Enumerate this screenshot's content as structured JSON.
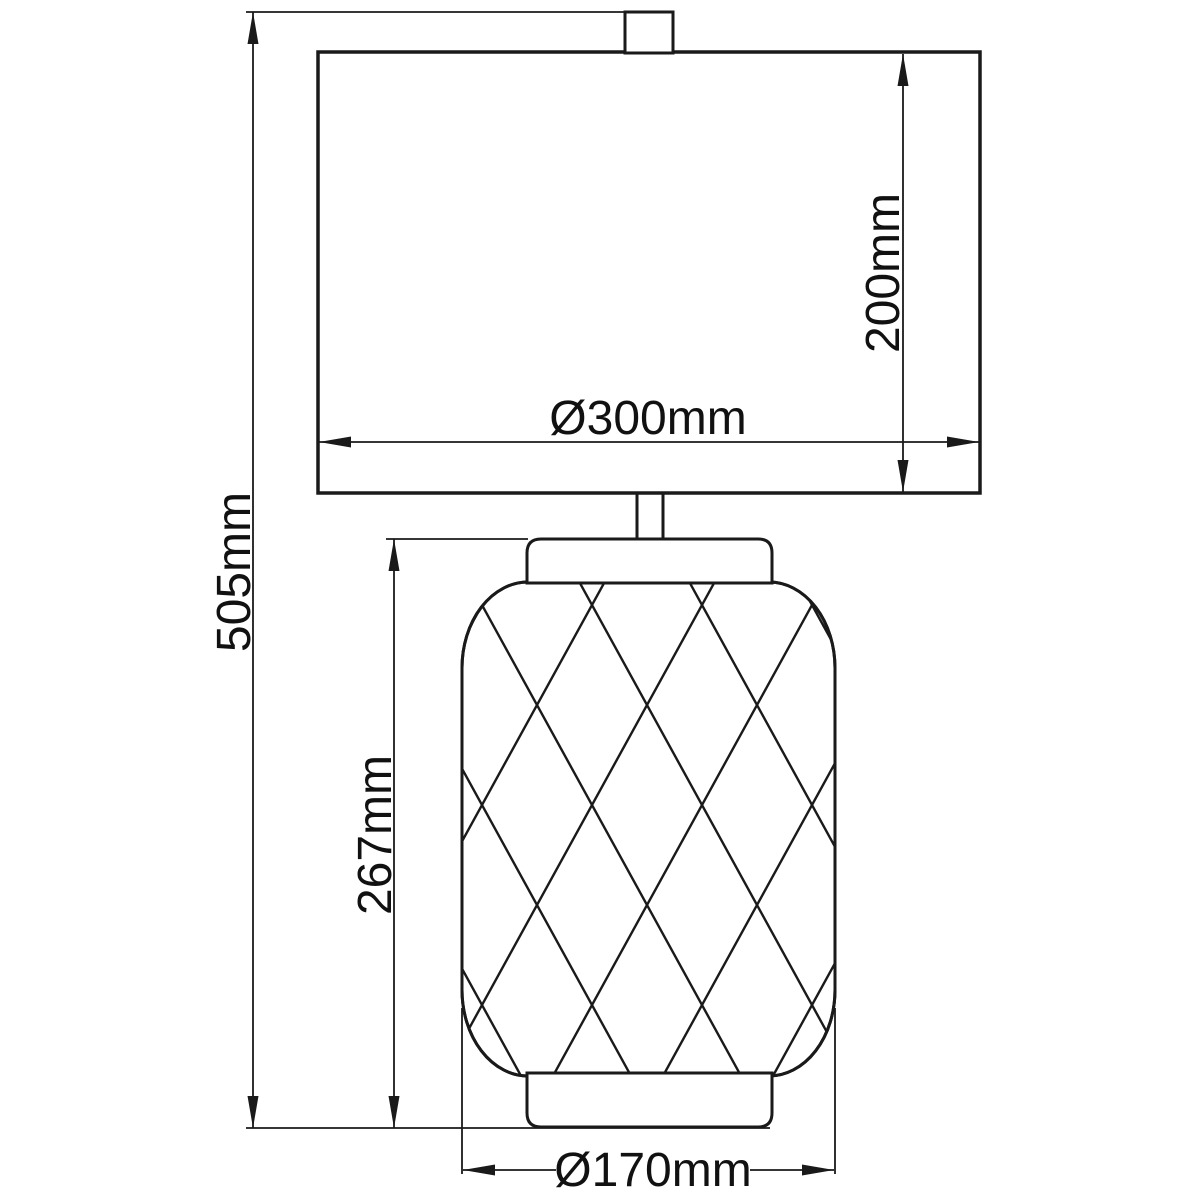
{
  "drawing": {
    "background_color": "#ffffff",
    "line_color": "#1a1a1a",
    "text_color": "#111111",
    "dimensions": {
      "overall_height": {
        "label": "505mm"
      },
      "base_height": {
        "label": "267mm"
      },
      "shade_height": {
        "label": "200mm"
      },
      "shade_diameter": {
        "label": "Ø300mm"
      },
      "base_diameter": {
        "label": "Ø170mm"
      }
    }
  }
}
